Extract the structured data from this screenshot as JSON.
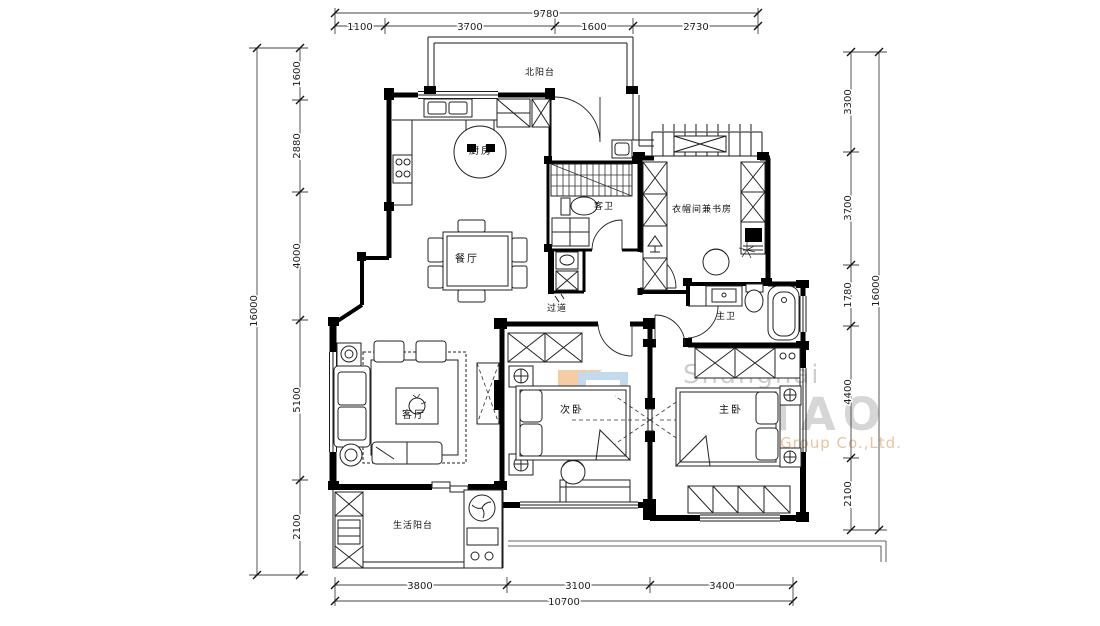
{
  "plan": {
    "rooms": {
      "north_balcony": "北阳台",
      "kitchen": "厨房",
      "guest_bath": "客卫",
      "study": "衣帽间兼书房",
      "dining": "餐厅",
      "corridor": "过道",
      "master_bath": "主卫",
      "living": "客厅",
      "second_bedroom": "次卧",
      "master_bedroom": "主卧",
      "service_balcony": "生活阳台"
    },
    "dimensions": {
      "top": {
        "total": "9780",
        "segments": [
          "1100",
          "3700",
          "1600",
          "2730"
        ]
      },
      "bottom": {
        "total": "10700",
        "segments": [
          "3800",
          "3100",
          "3400"
        ]
      },
      "left": {
        "total": "16000",
        "segments": [
          "1600",
          "2880",
          "4000",
          "5100",
          "2100"
        ]
      },
      "right": {
        "total": "16000",
        "segments": [
          "3300",
          "3700",
          "1780",
          "4400",
          "2100"
        ]
      }
    }
  },
  "watermark": {
    "line1": "Shanghai",
    "line2": "BOTAO",
    "line3": "Decoration Group Co.,Ltd.",
    "colors": {
      "text_gray": "#cdcdcd",
      "accent_orange": "#e9bd92",
      "logo_blue": "#bcd7ea",
      "logo_peach": "#f6c79b"
    }
  }
}
